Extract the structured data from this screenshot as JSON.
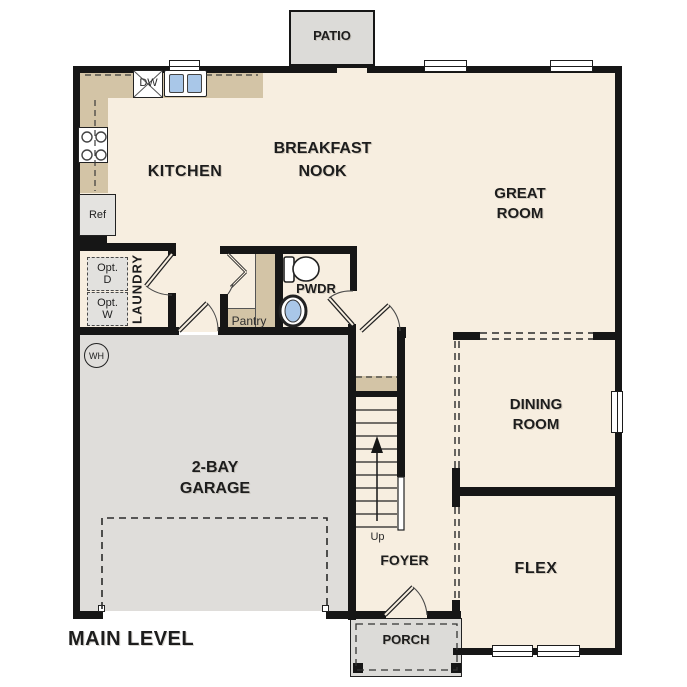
{
  "floor_title": "MAIN LEVEL",
  "colors": {
    "floor": "#f7eee0",
    "counter_tan": "#d3c4a6",
    "concrete_gray": "#dfddda",
    "wall": "#161616",
    "sink_blue": "#a9c7e8"
  },
  "rooms": {
    "patio": {
      "label": "PATIO"
    },
    "kitchen": {
      "label": "KITCHEN"
    },
    "breakfast_nook": {
      "line1": "BREAKFAST",
      "line2": "NOOK"
    },
    "great_room": {
      "line1": "GREAT",
      "line2": "ROOM"
    },
    "laundry": {
      "label": "LAUNDRY"
    },
    "pantry": {
      "label": "Pantry"
    },
    "powder_room": {
      "label": "PWDR"
    },
    "dining_room": {
      "line1": "DINING",
      "line2": "ROOM"
    },
    "garage": {
      "line1": "2-BAY",
      "line2": "GARAGE"
    },
    "foyer": {
      "label": "FOYER"
    },
    "flex": {
      "label": "FLEX"
    },
    "porch": {
      "label": "PORCH"
    }
  },
  "fixtures": {
    "dishwasher": {
      "label": "DW"
    },
    "refrigerator": {
      "label": "Ref"
    },
    "optional_dryer": {
      "line1": "Opt.",
      "line2": "D"
    },
    "optional_washer": {
      "line1": "Opt.",
      "line2": "W"
    },
    "water_heater": {
      "label": "WH"
    },
    "stairs": {
      "label": "Up"
    }
  }
}
